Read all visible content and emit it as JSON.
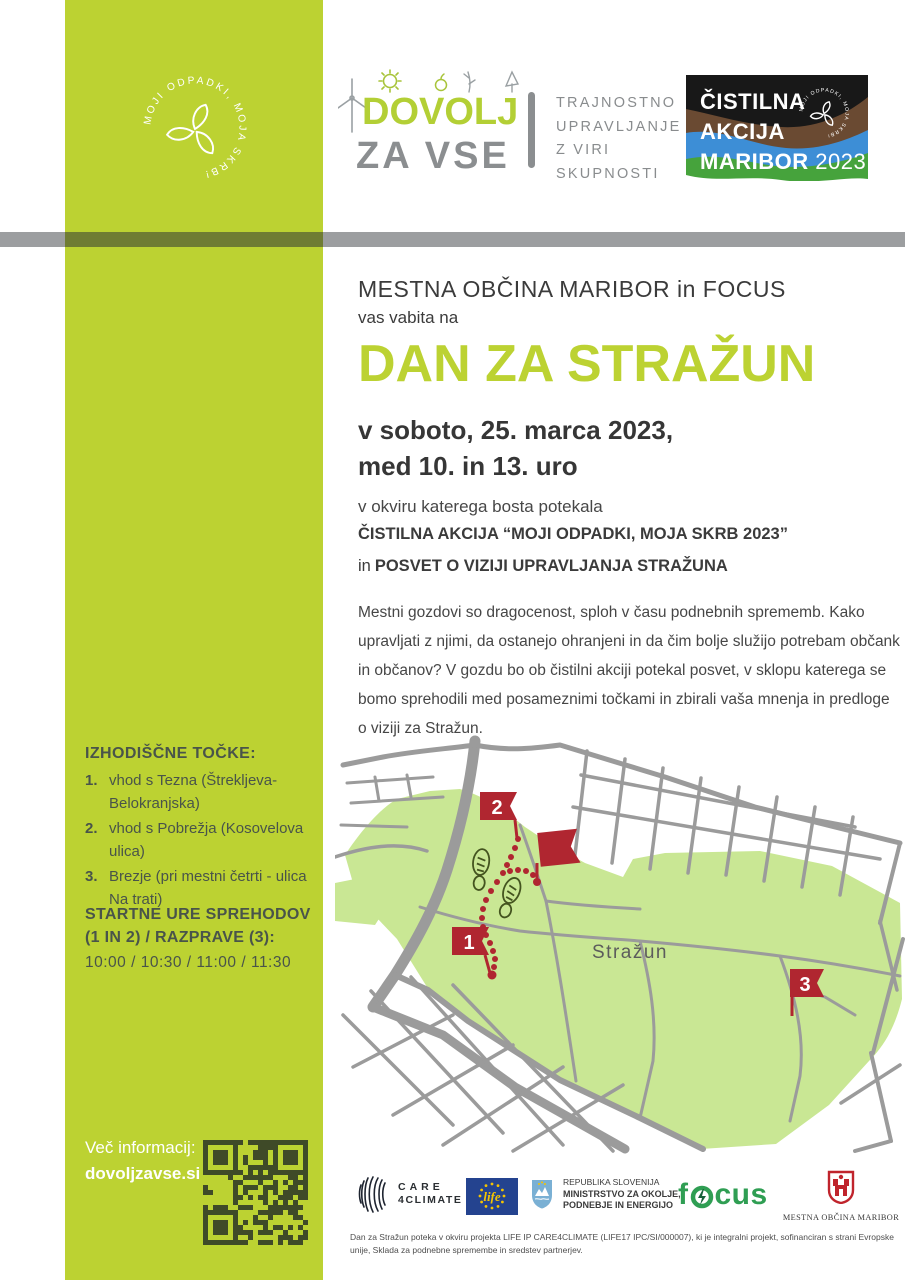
{
  "colors": {
    "brand_green": "#bcd232",
    "dark_olive_bar": "#6f7c33",
    "flag_red": "#b02630",
    "map_forest_green": "#c9e794",
    "road_gray": "#9b9b9b",
    "text_dark": "#3b3b3b",
    "logo_gray": "#8b8e90",
    "focus_green": "#2f9e53",
    "eu_blue": "#24438f"
  },
  "sidebar": {
    "circle_logo_text": "MOJI ODPADKI, MOJA SKRB!",
    "points_heading": "IZHODIŠČNE TOČKE:",
    "points": [
      {
        "num": "1.",
        "label": "vhod s Tezna (Štrekljeva-Belokranjska)"
      },
      {
        "num": "2.",
        "label": "vhod s Pobrežja (Kosovelova ulica)"
      },
      {
        "num": "3.",
        "label": "Brezje (pri mestni četrti - ulica Na trati)"
      }
    ],
    "times_heading": "STARTNE URE SPREHODOV (1 IN 2) / RAZPRAVE (3):",
    "times": "10:00 / 10:30 / 11:00 / 11:30",
    "info_label": "Več informacij:",
    "info_url": "dovoljzavse.si"
  },
  "header": {
    "logo_line1": "DOVOLJ",
    "logo_line2": "ZA VSE",
    "tagline": [
      "TRAJNOSTNO",
      "UPRAVLJANJE",
      "Z VIRI",
      "SKUPNOSTI"
    ],
    "badge": {
      "line1": "ČISTILNA",
      "line2": "AKCIJA",
      "line3": "MARIBOR",
      "year": "2023",
      "circle_text": "MOJI ODPADKI, MOJA SKRB!"
    }
  },
  "main": {
    "organizers": "MESTNA OBČINA MARIBOR in FOCUS",
    "invite": "vas vabita na",
    "title": "DAN ZA STRAŽUN",
    "date1": "v soboto, 25. marca 2023,",
    "date2": "med 10. in 13. uro",
    "frame": "v okviru katerega bosta potekala",
    "event1": "ČISTILNA AKCIJA “MOJI ODPADKI, MOJA SKRB 2023”",
    "event2_prefix": "in",
    "event2": "POSVET O VIZIJI UPRAVLJANJA STRAŽUNA",
    "paragraph": "Mestni gozdovi so dragocenost, sploh v času podnebnih sprememb. Kako upravljati z njimi, da ostanejo ohranjeni in da čim bolje služijo potrebam občank in občanov? V gozdu bo ob čistilni akciji potekal posvet, v sklopu katerega se bomo sprehodili med posameznimi točkami in zbirali vaša mnenja in predloge o viziji za Stražun."
  },
  "map": {
    "area_label": "Stražun",
    "marker1": "1",
    "marker2": "2",
    "marker3": "3"
  },
  "footer": {
    "care": {
      "line1": "CARE",
      "line2": "4CLIMATE"
    },
    "life": "life",
    "ministry": {
      "line1": "REPUBLIKA SLOVENIJA",
      "line2": "MINISTRSTVO ZA OKOLJE,",
      "line3": "PODNEBJE IN ENERGIJO"
    },
    "focus_f": "f",
    "focus_rest": "cus",
    "maribor": "MESTNA OBČINA MARIBOR",
    "fine_print": "Dan za Stražun poteka v okviru projekta LIFE IP CARE4CLIMATE (LIFE17 IPC/SI/000007), ki je integralni projekt, sofinanciran s strani Evropske unije, Sklada za podnebne spremembe in sredstev partnerjev."
  }
}
